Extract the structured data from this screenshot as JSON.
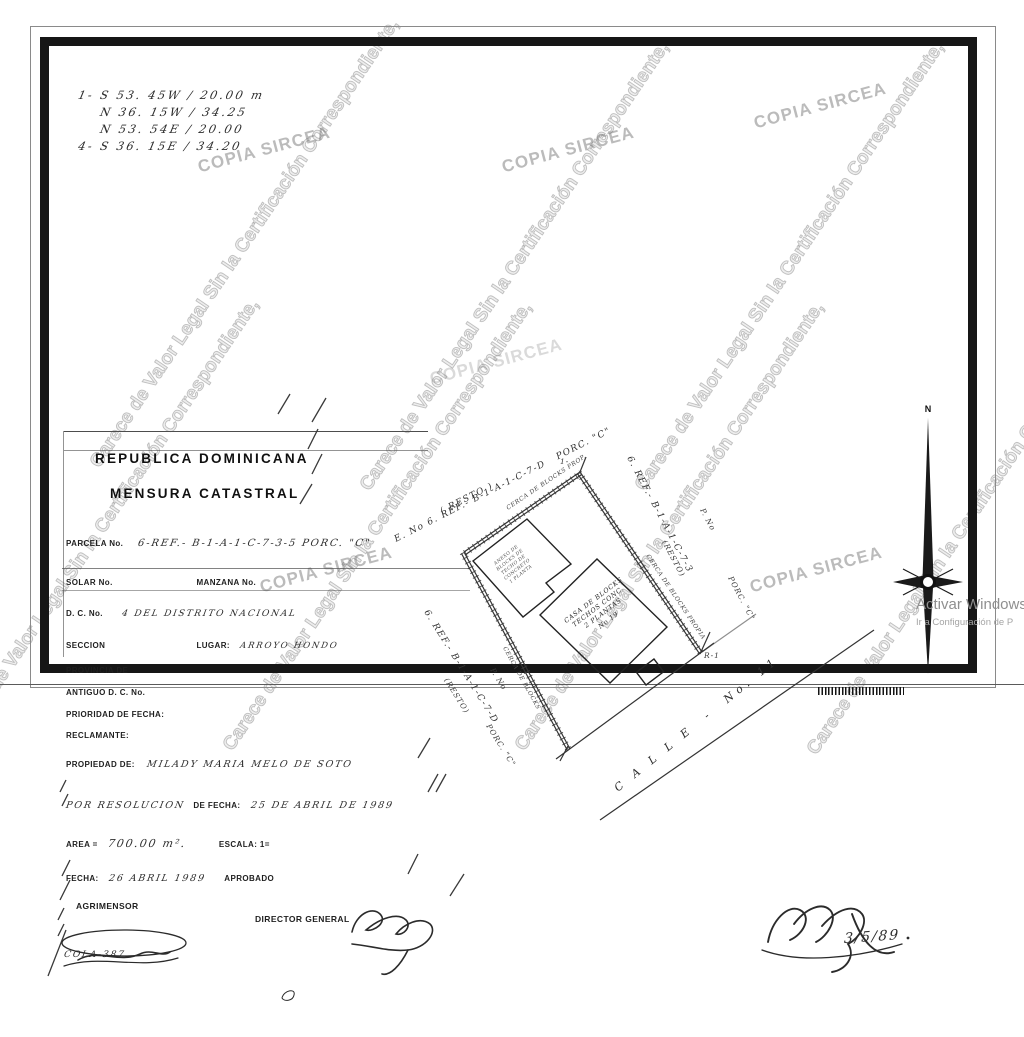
{
  "watermark": {
    "carece": "Carece de Valor Legal Sin la Certificación Correspondiente,",
    "copia": "COPIA SIRCEA"
  },
  "measurements": {
    "rows": [
      "1-  S 53. 45W / 20.00    m",
      "N 36. 15W / 34.25",
      "N 53. 54E / 20.00",
      "4-  S 36. 15E / 34.20"
    ]
  },
  "plot": {
    "compass_n": "N",
    "corner_label_top": "1-",
    "corner_label_right": "R-1",
    "fence_nw_label": "CERCA DE BLOCKS PROP.",
    "fence_ne_label": "CERCA DE BLOCKS PROPIA",
    "fence_sw_label": "CERCA DE BLOCKS",
    "neighbor_top": "E. No 6. REF.- B-1-A-1-C-7-D   PORC. \"C\"",
    "neighbor_top_resto": "( RESTO )",
    "neighbor_right_pno": "P. No",
    "neighbor_right": "6. REF.- B-1-A-1-C-7-3",
    "neighbor_right_resto": "(RESTO)",
    "neighbor_right_porc": "PORC. \"C\"",
    "neighbor_left_pno": "P. No",
    "neighbor_left": "6. REF.- B-1-A-1-C-7-D",
    "neighbor_left_resto": "(RESTO)",
    "neighbor_left_porc": "PORC. \"C\"",
    "street_label": "C A L L E  -  No. 11",
    "main_building": [
      "CASA DE BLOCKS",
      "TECHOS CONC.",
      "2 PLANTAS",
      "No 19"
    ],
    "annex_building": [
      "ANEXO DE",
      "BLOCKS DE",
      "TECHO DE",
      "CONCRETO",
      "1 PLANTA"
    ]
  },
  "form": {
    "title1": "REPUBLICA DOMINICANA",
    "title2": "MENSURA CATASTRAL",
    "parcela_label": "PARCELA No.",
    "parcela_value": "6-REF.- B-1-A-1-C-7-3-5  PORC. \"C\"",
    "solar_label": "SOLAR No.",
    "manzana_label": "MANZANA No.",
    "dc_label": "D. C. No.",
    "dc_value": "4   DEL  DISTRITO NACIONAL",
    "seccion_label": "SECCION",
    "lugar_label": "LUGAR:",
    "lugar_value": "ARROYO HONDO",
    "provincia_label": "PROVINCIA DE",
    "antiguo_label": "ANTIGUO D. C. No.",
    "prioridad_label": "PRIORIDAD DE FECHA:",
    "reclamante_label": "RECLAMANTE:",
    "propiedad_label": "PROPIEDAD DE:",
    "propiedad_value": "MILADY  MARIA  MELO DE SOTO",
    "resolucion_hand": "POR RESOLUCION",
    "resolucion_label": "DE FECHA:",
    "resolucion_value": "25 DE  ABRIL DE 1989",
    "area_label": "AREA =",
    "area_value": "700.00 m².",
    "escala_label": "ESCALA: 1=",
    "fecha_label": "FECHA:",
    "fecha_value": "26 ABRIL 1989",
    "aprobado_label": "APROBADO",
    "agrimensor_label": "AGRIMENSOR",
    "director_label": "DIRECTOR GENERAL",
    "colegiatura": "COLA-387",
    "sign_date": "3/5/89"
  },
  "windows_overlay": {
    "line1": "Activar Windows",
    "line2": "Ir a Configuración de P"
  }
}
